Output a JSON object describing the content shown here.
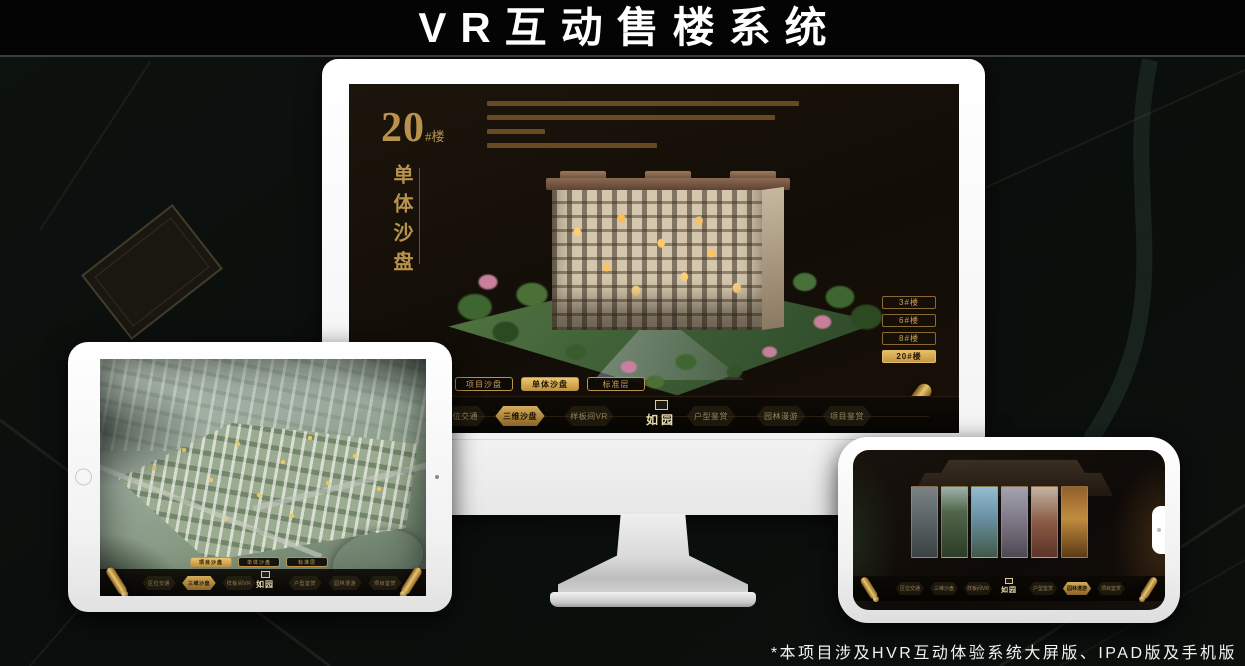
{
  "page": {
    "title": "VR互动售楼系统",
    "footnote": "*本项目涉及HVR互动体验系统大屏版、IPAD版及手机版"
  },
  "brand": {
    "logo": "如园",
    "gold": "#c9a258",
    "gold_bright": "#e6bd66",
    "screen_bg": "#161009"
  },
  "nav_items": [
    {
      "label": "区位交通"
    },
    {
      "label": "三维沙盘"
    },
    {
      "label": "样板间VR"
    },
    {
      "label": "户型鉴赏"
    },
    {
      "label": "园林漫游"
    },
    {
      "label": "项目鉴赏"
    }
  ],
  "subtabs": [
    {
      "label": "项目沙盘"
    },
    {
      "label": "单体沙盘"
    },
    {
      "label": "标准层"
    }
  ],
  "monitor": {
    "title_number": "20",
    "title_suffix": "#楼",
    "title_vertical": "单体沙盘",
    "active_subtab": "单体沙盘",
    "active_nav": "三维沙盘",
    "active_building": "20#楼",
    "building_buttons": [
      {
        "label": "3#楼"
      },
      {
        "label": "6#楼"
      },
      {
        "label": "8#楼"
      },
      {
        "label": "20#楼"
      }
    ]
  },
  "tablet": {
    "active_subtab": "项目沙盘",
    "active_nav": "三维沙盘"
  },
  "phone": {
    "active_nav": "园林漫游"
  }
}
